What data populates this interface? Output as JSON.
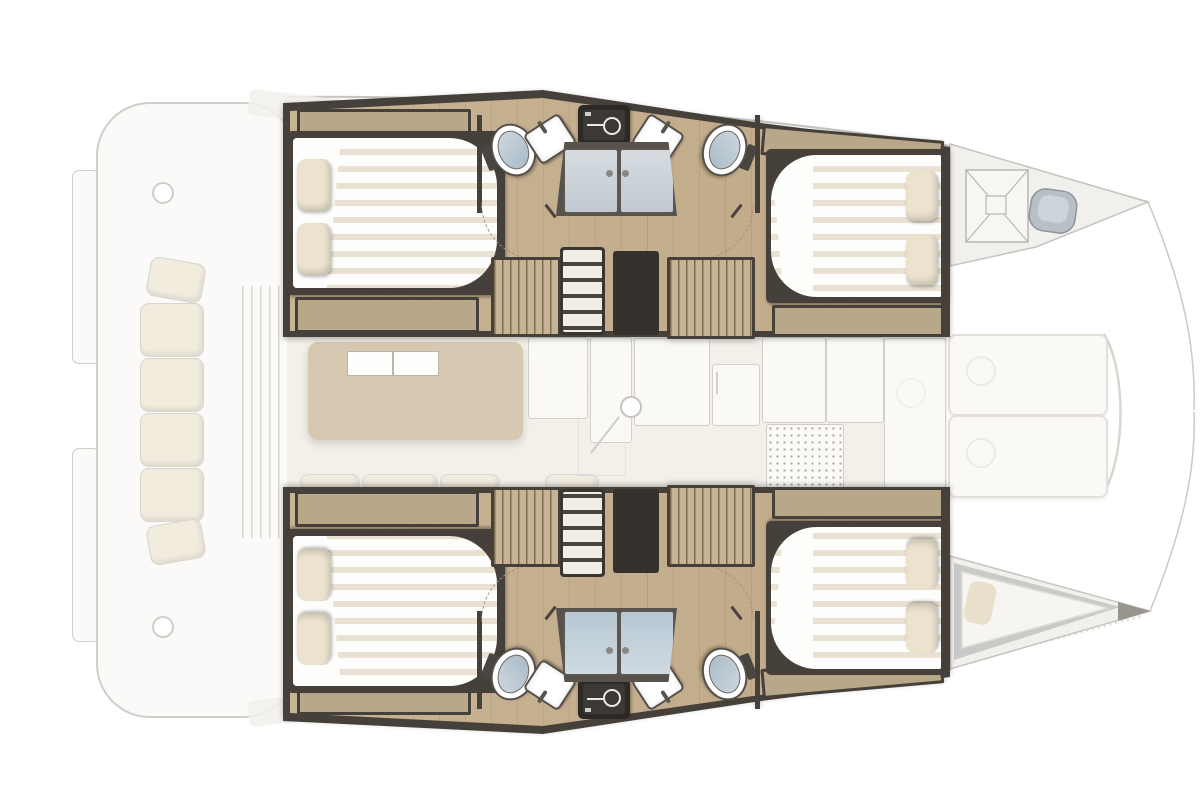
{
  "diagram": {
    "type": "catamaran-interior-floor-plan",
    "orientation": {
      "bow": "right",
      "stern": "left"
    },
    "decks": {
      "main_deck_ghosted": {
        "cockpit": [
          "swim-platforms",
          "aft-bench-cushions",
          "sliding-door",
          "winches",
          "coachroof-edges"
        ],
        "saloon": [
          "dining-table",
          "nav-station",
          "mast-post",
          "floor-hatch",
          "fridge",
          "galley-counters",
          "stove",
          "galley-sink-unit"
        ],
        "foredeck": [
          "sun-pad",
          "sun-pad",
          "crossbeam",
          "bowsprit-rigging-lines"
        ]
      },
      "lower_deck_detailed": {
        "port_hull": {
          "aft_cabin": [
            "double-bed",
            "pillows",
            "bench-locker",
            "top-locker"
          ],
          "bathroom": [
            "toilet",
            "washbasin",
            "equipment-panel",
            "washbasin",
            "toilet",
            "shared-shower-stall",
            "door-swing-arcs"
          ],
          "companionway": [
            "wardrobe",
            "stairs",
            "doorway",
            "wardrobe"
          ],
          "forward_cabin": [
            "double-bed",
            "pillows",
            "bench-locker",
            "top-locker"
          ]
        },
        "starboard_hull": "mirror-of-port-hull",
        "port_bow": [
          "forepeak-locker-hatch",
          "bow-seat"
        ],
        "starboard_bow": [
          "skipper-berth",
          "berth-pillow"
        ]
      }
    }
  },
  "colors": {
    "wood": "#c8b394",
    "wood2": "#bfa987",
    "wall": "#46403a",
    "trim": "#b8a789",
    "mattress": "#fdfdfc",
    "stripe": "#e9e2d3",
    "pillow": "#ece3cf",
    "shower_shell": "#57524b",
    "shower_door_a": "#d6dce0",
    "shower_door_b": "#c1c9d0",
    "toilet_seat_a": "#cdd8e0",
    "toilet_seat_b": "#a9bac6",
    "panel": "#2d2a26",
    "panel_inner": "#3c3934",
    "ghost_line": "#d0cec9",
    "ghost_fill": "#fbfaf8",
    "ghost_fill2": "#f1f0ec",
    "cushion": "#f2ecdf",
    "saloon_floor": "#f3f0ea",
    "table_tan": "#cfbfa3",
    "dot": "#b4b1ab",
    "arc": "#a3947a",
    "stair_tread": "#f0ede5",
    "hatch_dark": "#35312c",
    "berth_gray": "#c9c9c7"
  }
}
